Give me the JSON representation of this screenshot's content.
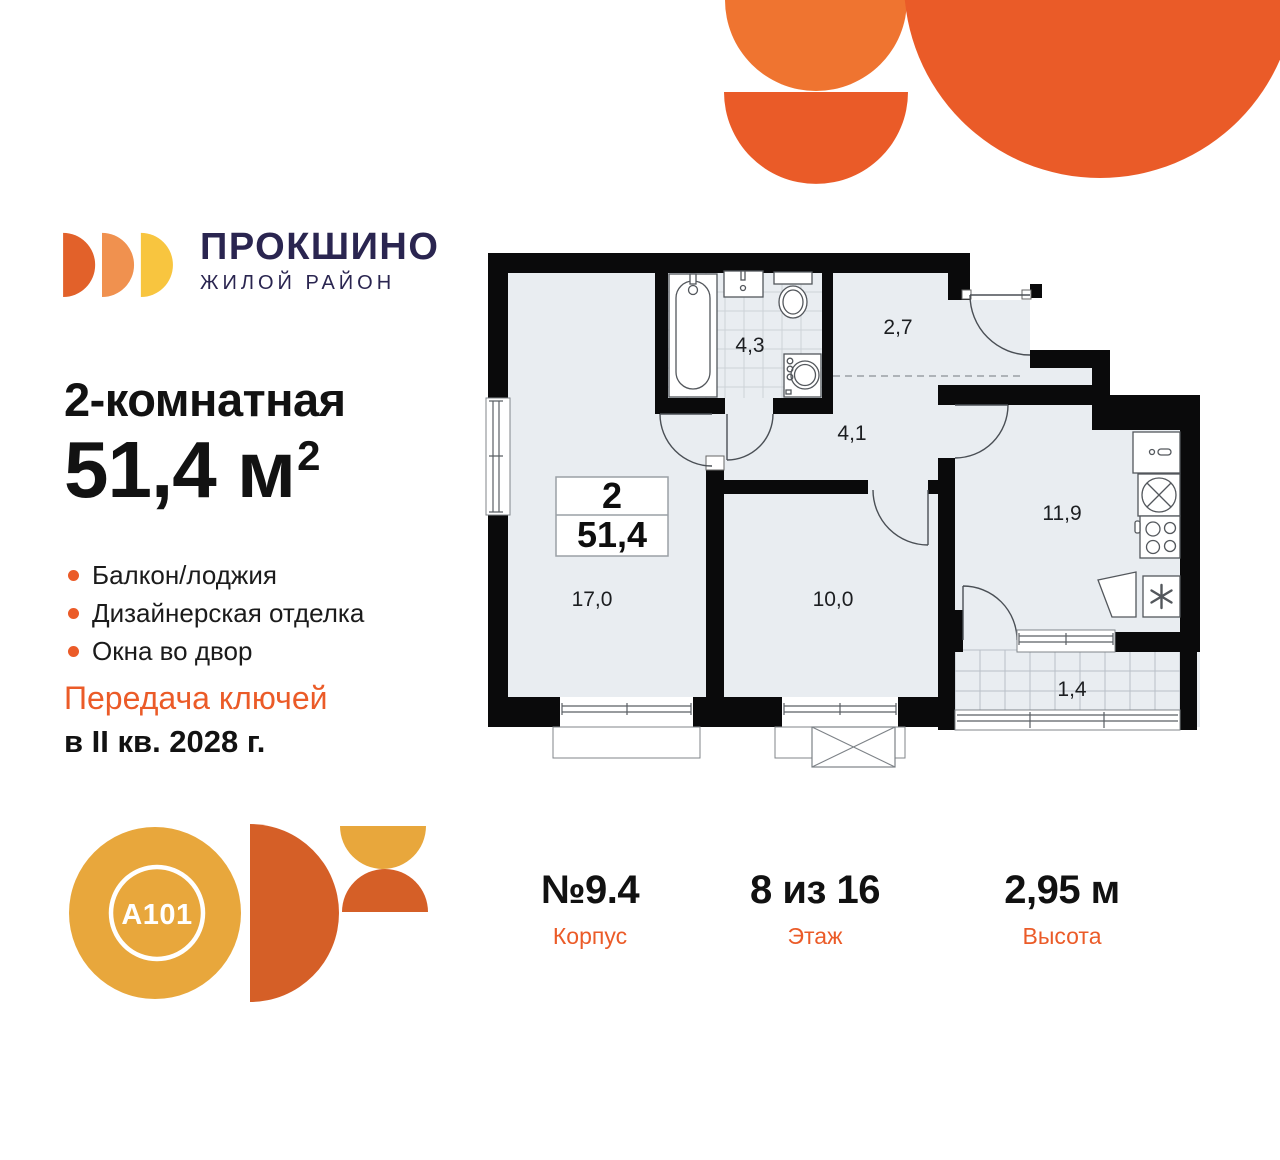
{
  "brand": {
    "name": "ПРОКШИНО",
    "tagline": "ЖИЛОЙ РАЙОН"
  },
  "listing": {
    "title": "2-комнатная",
    "area_text": "51,4 м",
    "area_sup": "2",
    "features": [
      "Балкон/лоджия",
      "Дизайнерская отделка",
      "Окна во двор"
    ],
    "handover_line1": "Передача ключей",
    "handover_line2": "в II кв. 2028 г."
  },
  "plan": {
    "info": {
      "rooms": "2",
      "area": "51,4"
    },
    "room_areas": {
      "living": "17,0",
      "bedroom": "10,0",
      "kitchen": "11,9",
      "bathroom": "4,3",
      "hall": "2,7",
      "corridor": "4,1",
      "balcony": "1,4"
    }
  },
  "developer": {
    "logo_text": "A101"
  },
  "stats": [
    {
      "value": "№9.4",
      "label": "Корпус"
    },
    {
      "value": "8 из 16",
      "label": "Этаж"
    },
    {
      "value": "2,95 м",
      "label": "Высота"
    }
  ],
  "colors": {
    "accent_orange": "#EB5B28",
    "light_orange": "#EF7430",
    "logo_orange": "#E2612A",
    "logo_light_orange": "#F0914F",
    "logo_yellow": "#F8C53F",
    "navy": "#2A2550",
    "golden": "#E8A73C",
    "plan_room_fill": "#E9EDF1"
  }
}
